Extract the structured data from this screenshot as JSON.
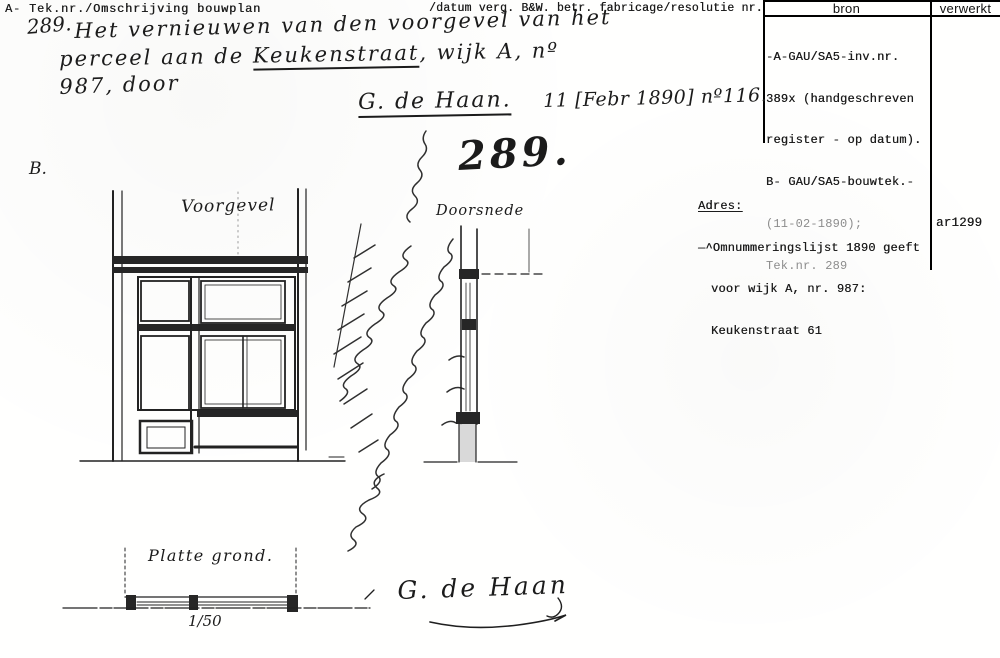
{
  "header": {
    "left": "A- Tek.nr./Omschrijving bouwplan",
    "mid": "/datum verg. B&W. betr. fabricage/resolutie nr."
  },
  "source_table": {
    "col_bron": "bron",
    "col_verwerkt": "verwerkt",
    "bron_lines": [
      "-A-GAU/SA5-inv.nr.",
      "389x (handgeschreven",
      "register - op datum).",
      "B- GAU/SA5-bouwtek.-"
    ],
    "bron_lines_faded": [
      "(11-02-1890);",
      "Tek.nr. 289"
    ],
    "verwerkt_value": "ar1299"
  },
  "adres": {
    "label": "Adres:",
    "line1": "—^Omnummeringslijst 1890 geeft",
    "line2": "voor wijk A, nr. 987:",
    "line3": "Keukenstraat 61"
  },
  "handwriting": {
    "item_number": "289.",
    "desc_line1": "Het vernieuwen van den voorgevel van het",
    "desc_line2_pre": "perceel aan de ",
    "desc_line2_underlined": "Keukenstraat",
    "desc_line2_post": ", wijk A, nº",
    "desc_line3": "987, door",
    "maker_name": "G. de Haan.",
    "maker_date": "11 [Febr 1890] nº116.",
    "section_letter": "B.",
    "drawing_number": "289.",
    "label_facade": "Voorgevel",
    "label_section": "Doorsnede",
    "label_floorplan": "Platte grond.",
    "scale": "1/50",
    "signature": "G. de Haan"
  },
  "colors": {
    "ink": "#1c1c1c",
    "faded_ink": "#8c8c8c",
    "paper": "#ffffff"
  }
}
